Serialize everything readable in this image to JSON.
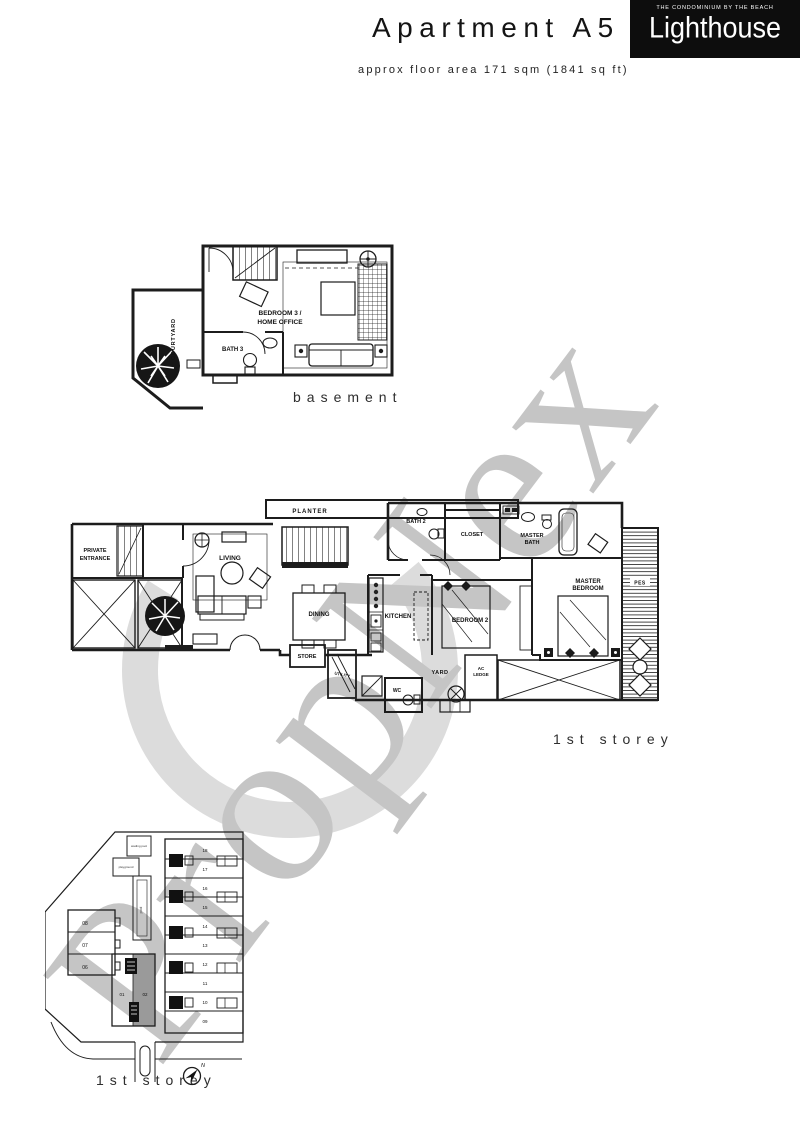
{
  "header": {
    "title": "Apartment A5",
    "logo_tagline": "THE CONDOMINIUM BY THE BEACH",
    "logo_name": "Lighthouse",
    "subtitle": "approx floor area 171 sqm (1841 sq ft)"
  },
  "watermark": {
    "text": "PropNex",
    "color": "#c5c5c5"
  },
  "basement": {
    "caption": "basement",
    "rooms": {
      "courtyard": "COURTYARD",
      "bedroom3_line1": "BEDROOM 3 /",
      "bedroom3_line2": "HOME OFFICE",
      "bath3": "BATH 3"
    }
  },
  "first_storey": {
    "caption": "1st storey",
    "rooms": {
      "planter": "PLANTER",
      "private_entrance_1": "PRIVATE",
      "private_entrance_2": "ENTRANCE",
      "living": "LIVING",
      "dining": "DINING",
      "kitchen": "KITCHEN",
      "store": "STORE",
      "utility": "UTILITY",
      "wc": "WC",
      "yard": "YARD",
      "ac_ledge_1": "AC",
      "ac_ledge_2": "LEDGE",
      "bath2": "BATH 2",
      "closet": "CLOSET",
      "master_bath_1": "MASTER",
      "master_bath_2": "BATH",
      "bedroom2": "BEDROOM 2",
      "master_bedroom_1": "MASTER",
      "master_bedroom_2": "BEDROOM",
      "pes": "PES"
    }
  },
  "site_plan": {
    "caption": "1st storey",
    "north_label": "N",
    "highlighted_unit": "02",
    "highlight_color": "#9a9a9a",
    "units_left": [
      "08",
      "07",
      "06"
    ],
    "units_court": [
      "01",
      "02"
    ],
    "units_right": [
      "18",
      "17",
      "16",
      "15",
      "14",
      "13",
      "12",
      "11",
      "10",
      "09"
    ],
    "amenities": {
      "wading_pool": "wading pool",
      "playground": "playground",
      "pool": "pool"
    }
  },
  "ink": "#1c1c1c"
}
